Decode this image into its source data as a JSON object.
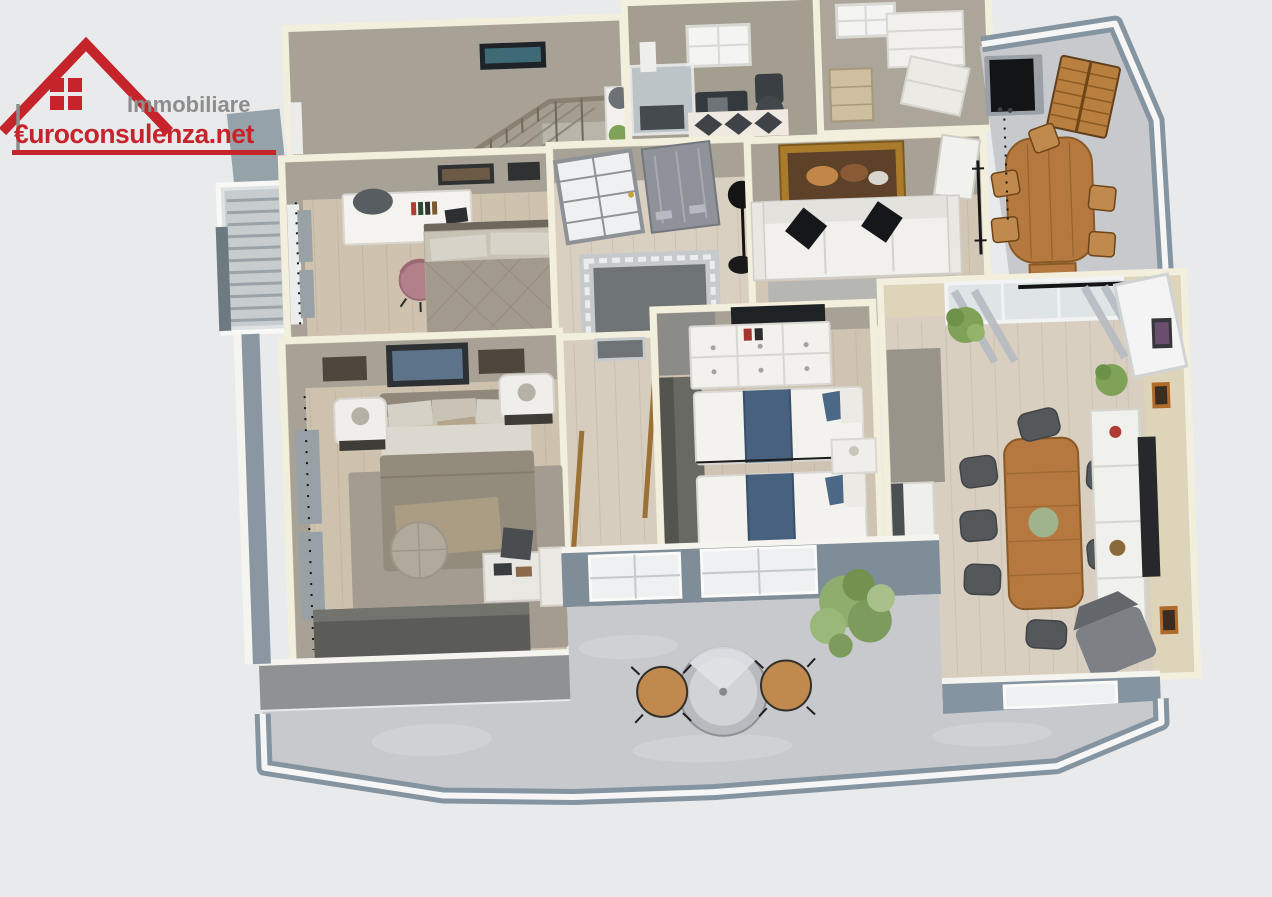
{
  "page": {
    "background": "#e9eaec"
  },
  "logo": {
    "brand_line": "Immobiliare",
    "domain_line": "€uroconsulenza.net",
    "brand_color": "#8d8d8d",
    "domain_color": "#c5242a",
    "house_icon_color": "#c5242a"
  },
  "palette": {
    "wall_cap": "#f3efdd",
    "wall_face_taupe": "#a8a296",
    "wall_face_beige": "#ded4ba",
    "wood_floor": "#cfc3b0",
    "terrace_floor": "#c8c9cd",
    "parapet_blue_gray": "#8494a0",
    "accent_wood": "#b5793f",
    "sofa_white": "#f1f0ec",
    "cushion_black": "#15171a",
    "plant_green": "#7fa257"
  },
  "scene": {
    "type": "3d-floor-plan-render",
    "view": "top-down dollhouse view, slightly rotated counter-clockwise",
    "rooms": [
      {
        "name": "landing-stair-room",
        "furniture": [
          "staircase-with-railing",
          "wall-tv",
          "plant-pedestal"
        ]
      },
      {
        "name": "bathroom",
        "furniture": [
          "glass-shower",
          "dark-vanity",
          "toilet",
          "diamond-rug",
          "window"
        ]
      },
      {
        "name": "laundry-closet",
        "furniture": [
          "white-cabinets",
          "beige-shelf",
          "window"
        ]
      },
      {
        "name": "upper-terrace",
        "furniture": [
          "bbq-grill",
          "dog-house",
          "wood-dining-table",
          "wood-chairs"
        ]
      },
      {
        "name": "left-balcony",
        "furniture": [
          "railing"
        ]
      },
      {
        "name": "bedroom-2",
        "furniture": [
          "desk",
          "desk-chair",
          "pink-chair",
          "double-bed",
          "wall-frames",
          "curtained-window"
        ]
      },
      {
        "name": "entry-hall",
        "furniture": [
          "glass-french-door",
          "gray-entry-door",
          "greek-key-rug",
          "floor-lamp"
        ]
      },
      {
        "name": "living-room",
        "furniture": [
          "white-sofa",
          "black-cushions",
          "gold-framed-painting",
          "gray-rug",
          "coat-rack"
        ]
      },
      {
        "name": "master-bedroom",
        "furniture": [
          "double-bed",
          "white-armchairs",
          "round-pouf",
          "gray-rug",
          "dark-wardrobe",
          "curtains",
          "wall-frames",
          "tray-table"
        ]
      },
      {
        "name": "kids-bedroom",
        "furniture": [
          "twin-bed-blue",
          "twin-bed-blue",
          "white-dresser",
          "tv",
          "nightstand",
          "gray-closet",
          "gray-rug"
        ]
      },
      {
        "name": "dining-living-room",
        "furniture": [
          "wood-dining-table",
          "dark-chairs",
          "white-sideboard",
          "wall-tv-panel",
          "lounge-chair",
          "plants",
          "kitchen-counter",
          "curtained-windows"
        ]
      },
      {
        "name": "main-terrace",
        "furniture": [
          "round-bistro-table",
          "two-wood-chairs",
          "green-bush"
        ]
      }
    ]
  }
}
